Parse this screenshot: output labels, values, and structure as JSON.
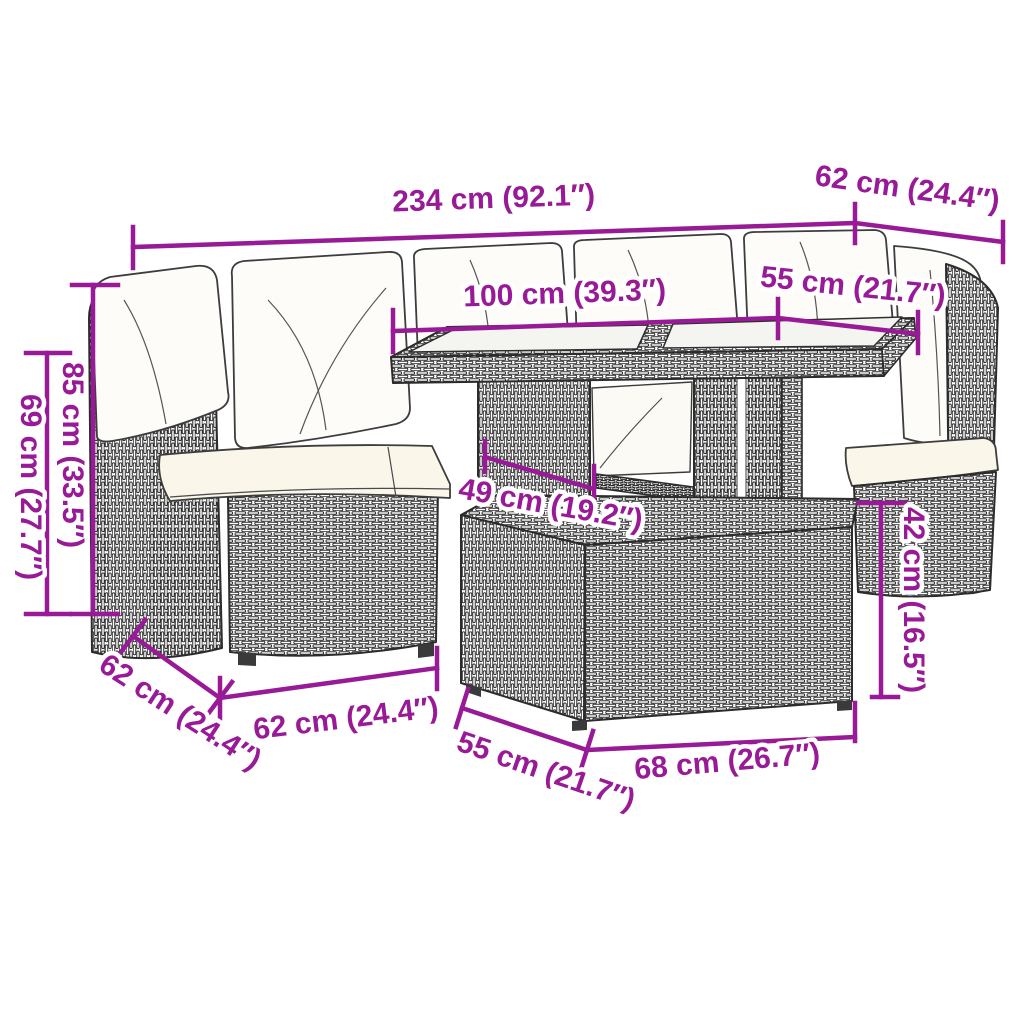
{
  "diagram": {
    "type": "product-dimension-diagram",
    "subject": "5-piece poly rattan garden lounge set with cushions, glass-top table and ottoman",
    "accent_color": "#981a96",
    "line_color": "#2c2c2c",
    "cushion_color": "#faf6ea",
    "glass_color": "#f4f4f1",
    "measurements": {
      "overall_width": "234 cm (92.1″)",
      "corner_depth": "62 cm (24.4″)",
      "table_length": "100 cm (39.3″)",
      "table_depth": "55 cm (21.7″)",
      "back_height": "85 cm (33.5″)",
      "armrest_height": "69 cm (27.7″)",
      "table_leg_span": "49 cm (19.2″)",
      "seat_height": "42 cm (16.5″)",
      "sofa_depth": "62 cm (24.4″)",
      "sofa_width": "62 cm (24.4″)",
      "ottoman_depth": "55 cm (21.7″)",
      "ottoman_width": "68 cm (26.7″)"
    }
  }
}
